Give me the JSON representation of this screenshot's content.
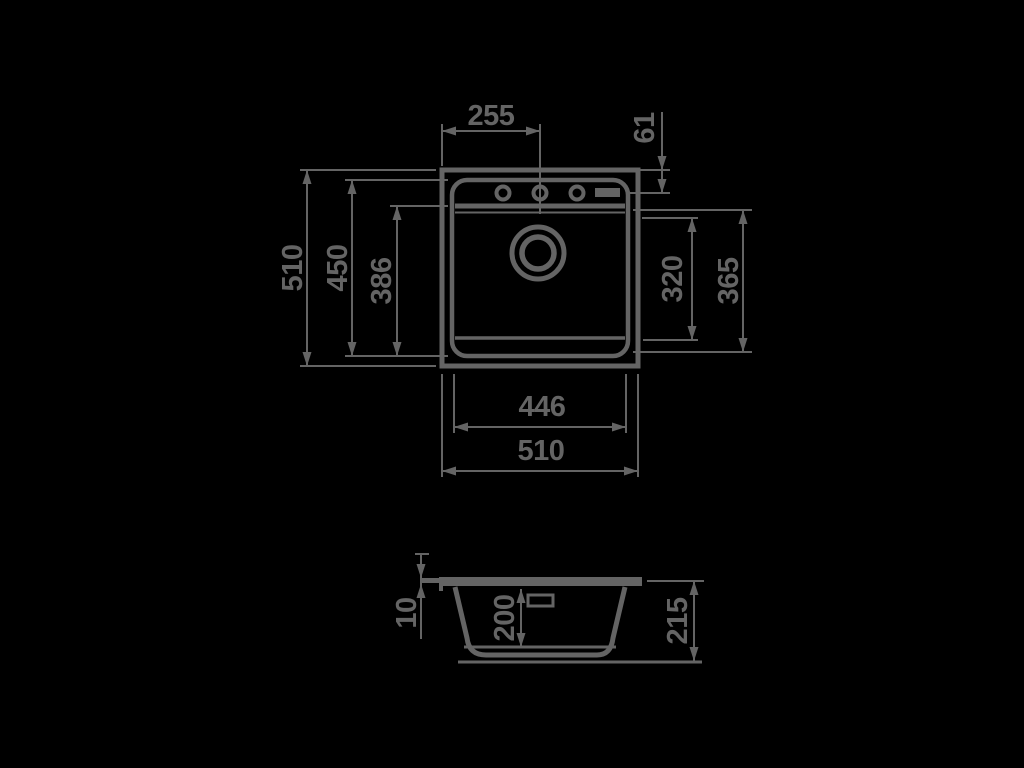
{
  "drawing_type": "sink-dimension-diagram",
  "colors": {
    "background": "#000000",
    "line": "#646464"
  },
  "top_view": {
    "width_to_center": "255",
    "edge_to_tap_holes": "61",
    "overall_height": "510",
    "rim_inner_height": "450",
    "deck_to_front": "386",
    "bowl_flat_height": "320",
    "bowl_full_height": "365",
    "bowl_width": "446",
    "overall_width": "510"
  },
  "side_view": {
    "rim_height": "10",
    "bowl_depth": "200",
    "overall_depth": "215"
  }
}
